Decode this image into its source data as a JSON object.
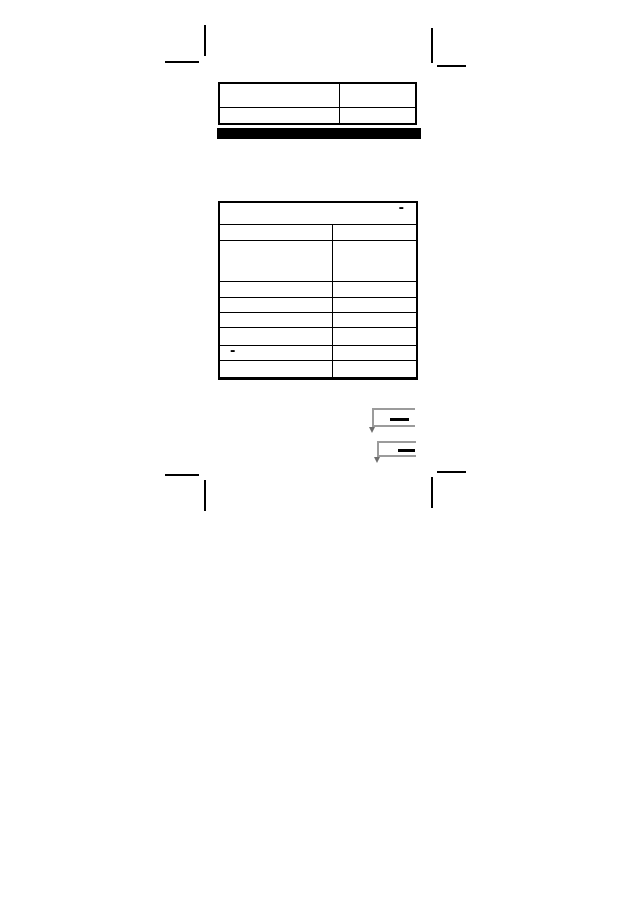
{
  "page": {
    "background_color": "#ffffff",
    "ink_color": "#000000",
    "figure_line_color": "#9b9b9b",
    "section_bar_color": "#000000"
  },
  "crop_marks": {
    "positions": [
      "top-left",
      "top-right",
      "bottom-left",
      "bottom-right"
    ]
  },
  "top_table": {
    "rows": [
      {
        "left": "",
        "right": ""
      },
      {
        "left": "",
        "right": ""
      }
    ]
  },
  "main_table": {
    "header": {
      "text": "",
      "corner_mark": "-"
    },
    "rows": [
      {
        "left": "",
        "right": ""
      },
      {
        "left": "",
        "right": ""
      },
      {
        "left": "",
        "right": ""
      },
      {
        "left": "",
        "right": ""
      },
      {
        "left": "",
        "right": ""
      },
      {
        "left": "",
        "right": ""
      },
      {
        "left": "-",
        "right": ""
      },
      {
        "left": "",
        "right": ""
      },
      {
        "left": "",
        "right": ""
      }
    ]
  },
  "figures": [
    {
      "name": "step-bracket-diagram-1"
    },
    {
      "name": "step-bracket-diagram-2"
    }
  ]
}
